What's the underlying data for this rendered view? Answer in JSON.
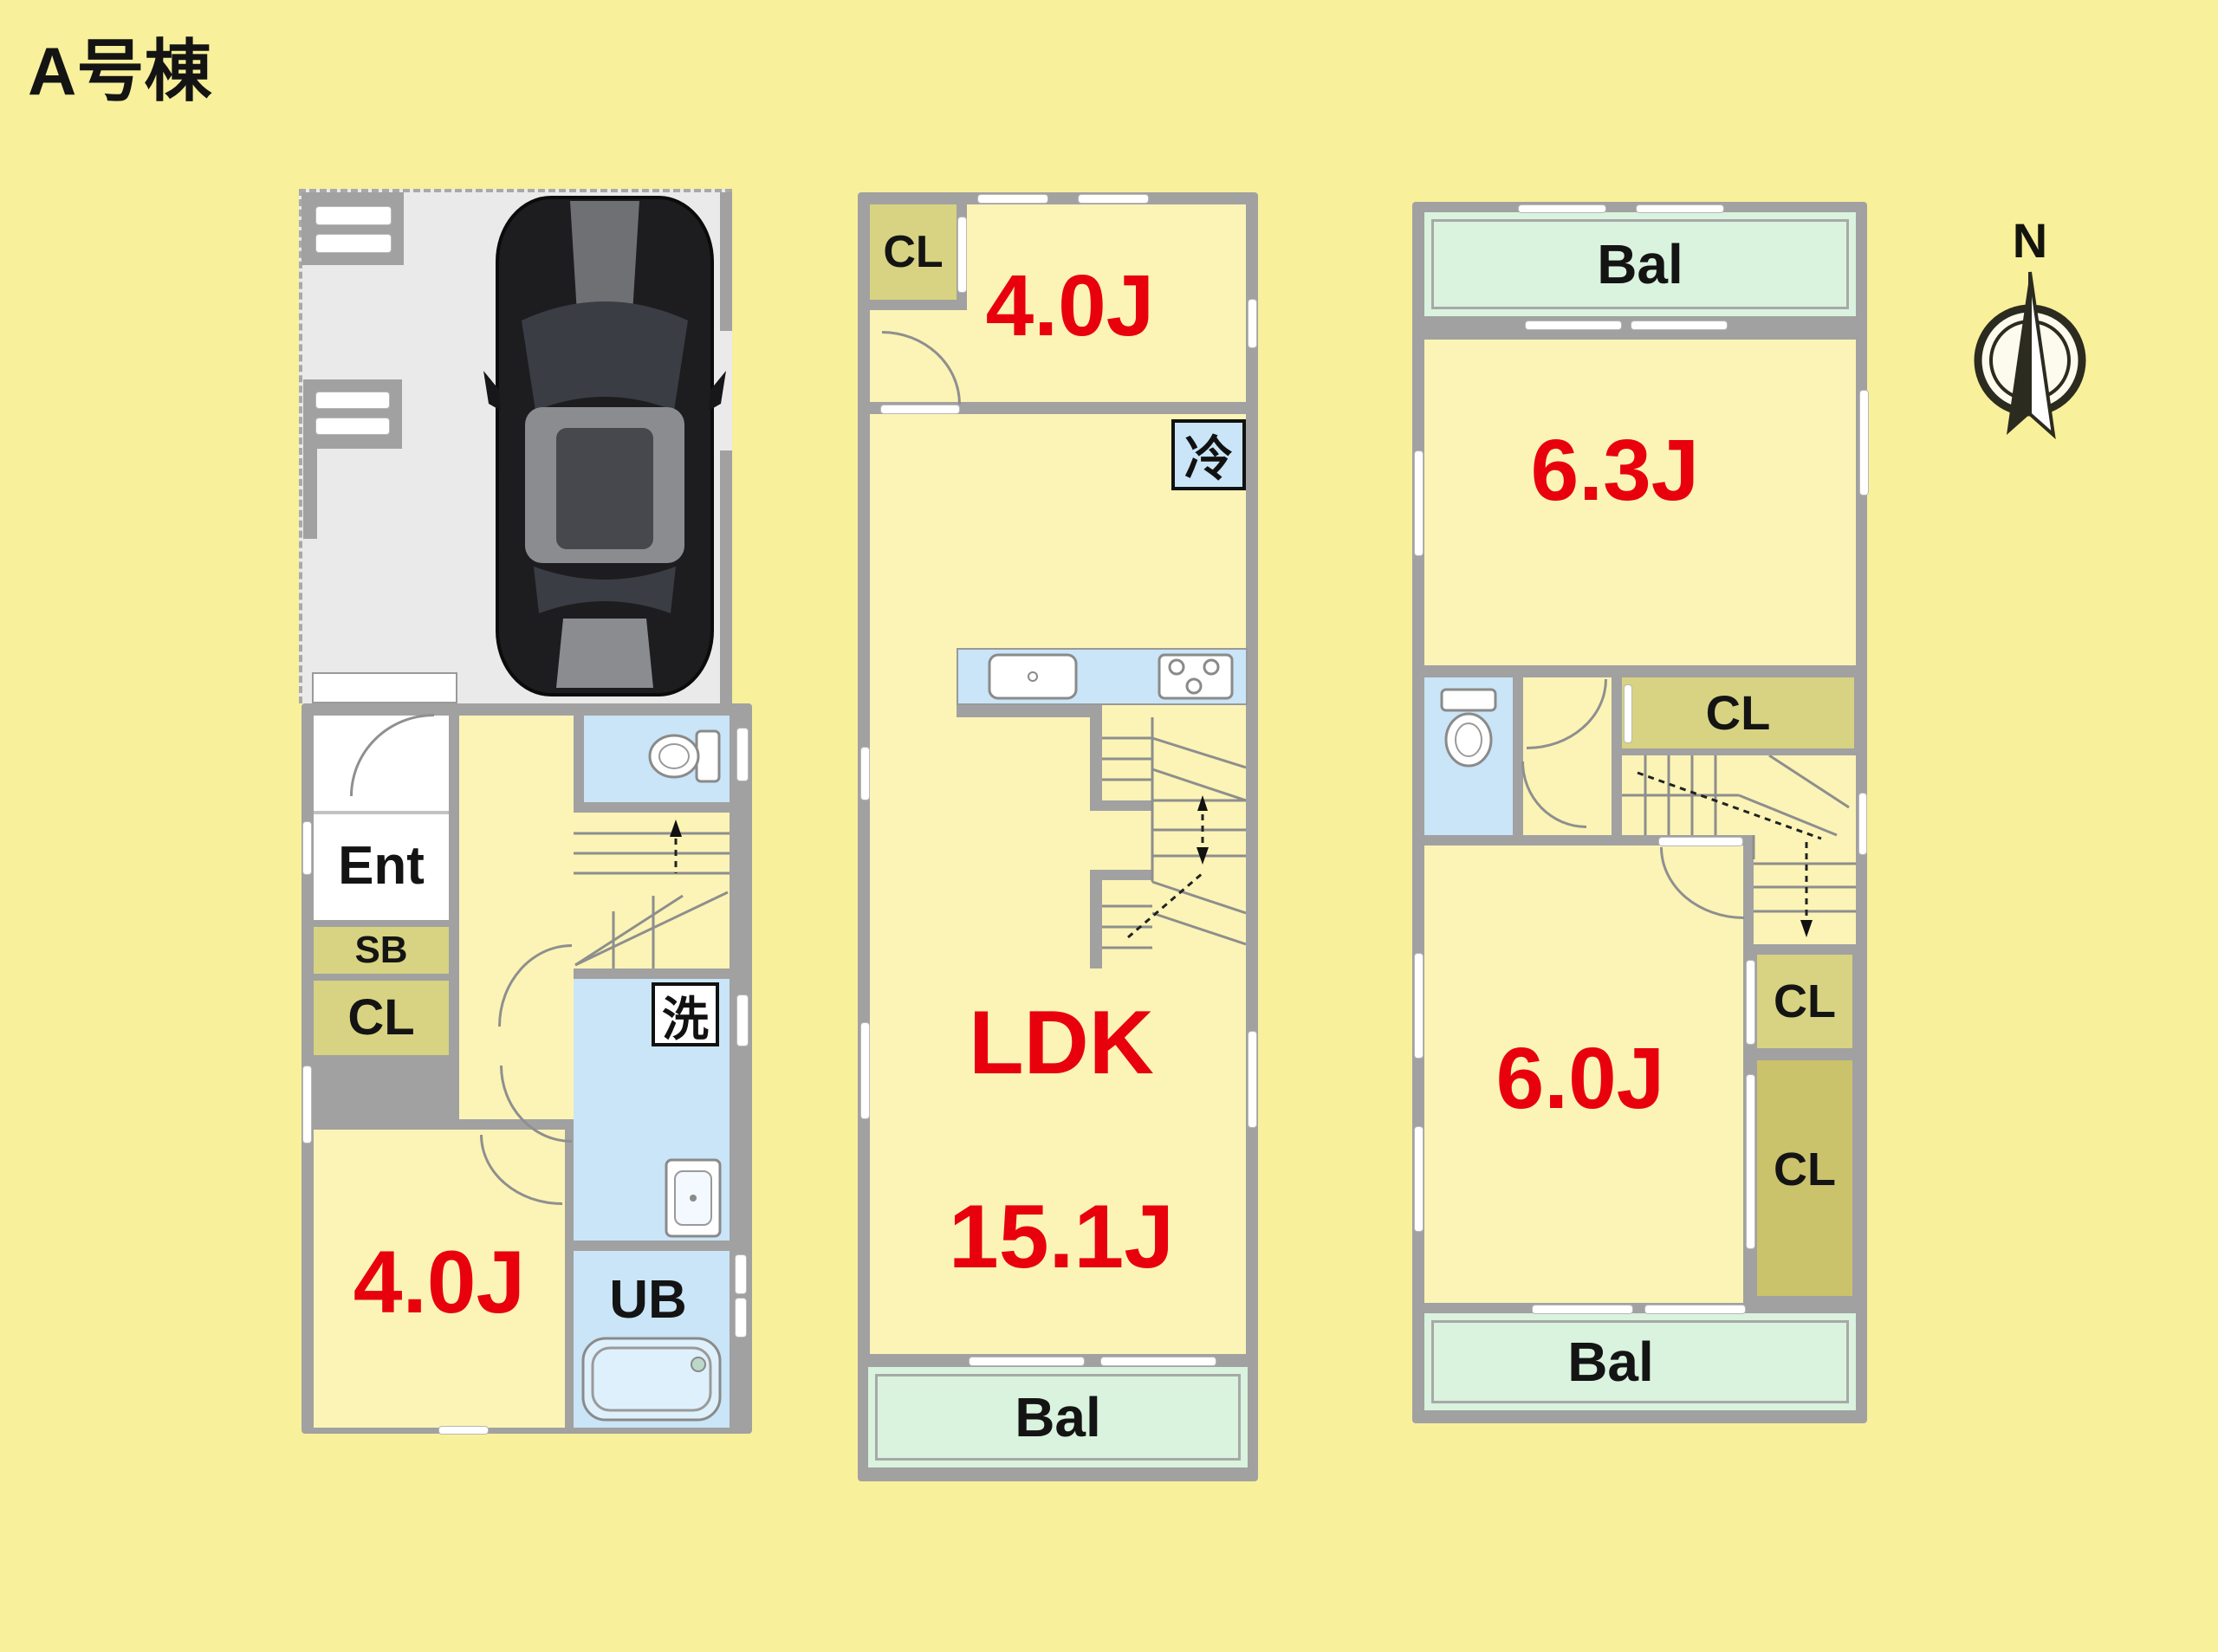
{
  "title": "A号棟",
  "compass": {
    "label": "N"
  },
  "colors": {
    "background": "#F8F09A",
    "room_yellow": "#FBF4B6",
    "wall_gray": "#A1A1A1",
    "water_blue": "#C9E5F7",
    "closet_olive": "#D7D382",
    "closet_dark_olive": "#CBC26C",
    "balcony_green": "#D9F3DE",
    "garage_gray": "#EAEAEA",
    "size_label_red": "#E8000D"
  },
  "floor1": {
    "rooms": {
      "ent": "Ent",
      "sb": "SB",
      "cl": "CL",
      "laundry": "洗",
      "bedroom": "4.0J",
      "bath": "UB"
    }
  },
  "floor2": {
    "rooms": {
      "cl": "CL",
      "bedroom": "4.0J",
      "fridge": "冷",
      "ldk": "LDK",
      "ldk_size": "15.1J",
      "balcony": "Bal"
    }
  },
  "floor3": {
    "rooms": {
      "balcony_north": "Bal",
      "bedroom_north": "6.3J",
      "cl_hall": "CL",
      "cl_upper": "CL",
      "cl_lower": "CL",
      "bedroom_south": "6.0J",
      "balcony_south": "Bal"
    }
  }
}
